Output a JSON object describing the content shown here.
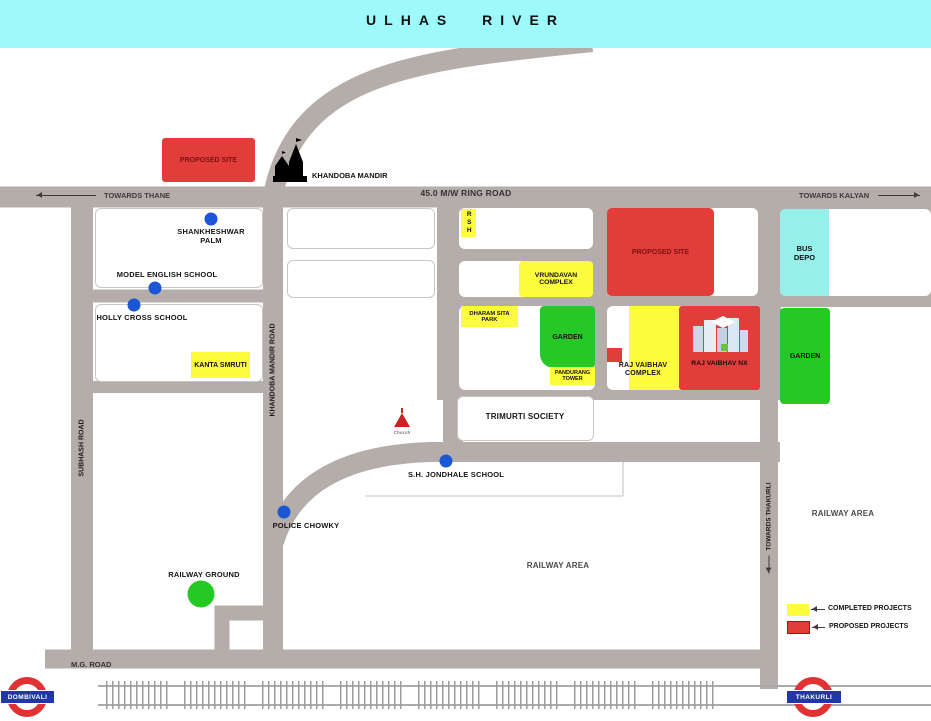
{
  "title_band": {
    "river": "ULHAS  RIVER"
  },
  "roads": {
    "ring_road": "45.0 M/W RING ROAD",
    "towards_thane": "TOWARDS THANE",
    "towards_kalyan": "TOWARDS KALYAN",
    "towards_thakurli": "TOWARDS THAKURLI",
    "subhash_road": "SUBHASH ROAD",
    "khandoba_mandir_road": "KHANDOBA MANDIR ROAD",
    "mg_road": "M.G. ROAD"
  },
  "projects": {
    "proposed_site_west": "PROPOSED SITE",
    "proposed_site_east": "PROPOSED SITE",
    "vrundavan_complex": "VRUNDAVAN\nCOMPLEX",
    "kanta_smruti": "KANTA SMRUTI",
    "rsh": "RSH",
    "dharam_sita_park": "DHARAM SITA\nPARK",
    "pandurang_tower": "PANDURANG\nTOWER",
    "raj_vaibhav_complex": "RAJ VAIBHAV\nCOMPLEX",
    "raj_vaibhav_nx": "RAJ VAIBHAV NX"
  },
  "places": {
    "khandoba_mandir": "KHANDOBA MANDIR",
    "shankheshwar_palm": "SHANKHESHWAR\nPALM",
    "model_english_school": "MODEL ENGLISH SCHOOL",
    "holly_cross_school": "HOLLY CROSS SCHOOL",
    "trimurti_society": "TRIMURTI SOCIETY",
    "church": "Church",
    "sh_jondhale_school": "S.H. JONDHALE  SCHOOL",
    "police_chowky": "POLICE CHOWKY",
    "railway_ground": "RAILWAY GROUND",
    "garden_mid": "GARDEN",
    "garden_east": "GARDEN",
    "bus_depo": "BUS\nDEPO",
    "railway_area_south": "RAILWAY AREA",
    "railway_area_east": "RAILWAY AREA"
  },
  "legend": {
    "completed": "COMPLETED PROJECTS",
    "proposed": "PROPOSED PROJECTS"
  },
  "stations": {
    "west": "DOMBIVALI",
    "east": "THAKURLI"
  },
  "colors": {
    "road": "#b5adaa",
    "river": "#9efafa",
    "completed_yellow": "#fdfd3d",
    "proposed_red": "#e23d3b",
    "garden_green": "#25c825",
    "bus_depo_cyan": "#97efec",
    "marker_blue": "#1b57d5",
    "station_red": "#e03232",
    "station_blue": "#2137a8"
  }
}
